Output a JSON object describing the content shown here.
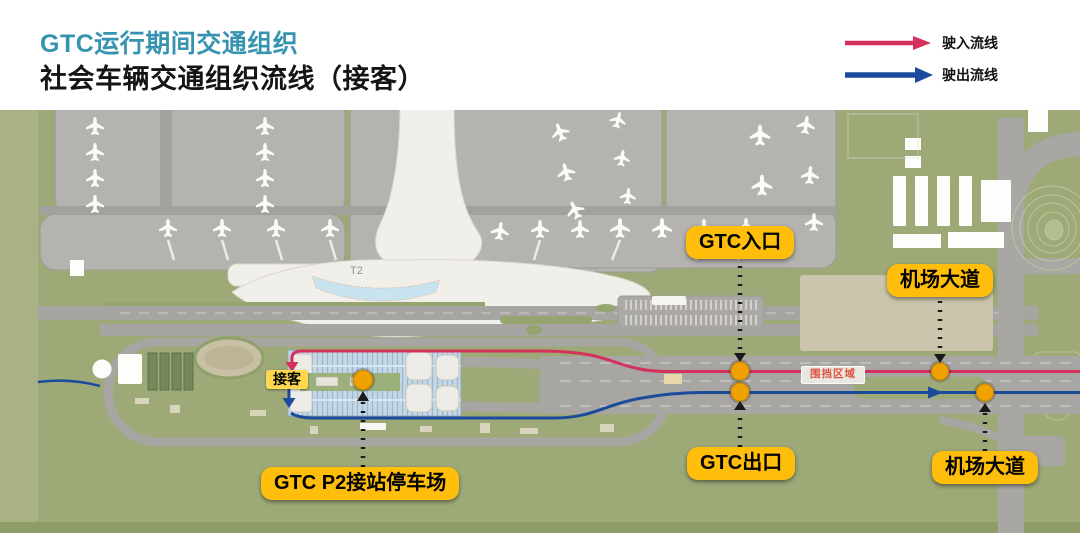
{
  "header": {
    "title": "GTC运行期间交通组织",
    "subtitle": "社会车辆交通组织流线（接客）",
    "title_color": "#3794B0"
  },
  "legend": {
    "inbound_label": "驶入流线",
    "outbound_label": "驶出流线",
    "inbound_color": "#D4315C",
    "outbound_color": "#1C4B9C"
  },
  "map": {
    "terminal_label": "T2",
    "pickup_tag": "接客",
    "enclosure_tag": "围挡区域",
    "callouts": {
      "gtc_entrance": "GTC入口",
      "airport_avenue_north": "机场大道",
      "gtc_exit": "GTC出口",
      "airport_avenue_south": "机场大道",
      "p2_parking": "GTC P2接站停车场"
    },
    "colors": {
      "callout_bg": "#FFBE0B",
      "inbound_line": "#D4315C",
      "outbound_line": "#1C4B9C",
      "marker_dot": "#F0A202",
      "grass": "#9DA977",
      "apron": "#B5B3AF",
      "road": "#A8A6A2",
      "parking_structure": "#C3D8E6"
    }
  }
}
